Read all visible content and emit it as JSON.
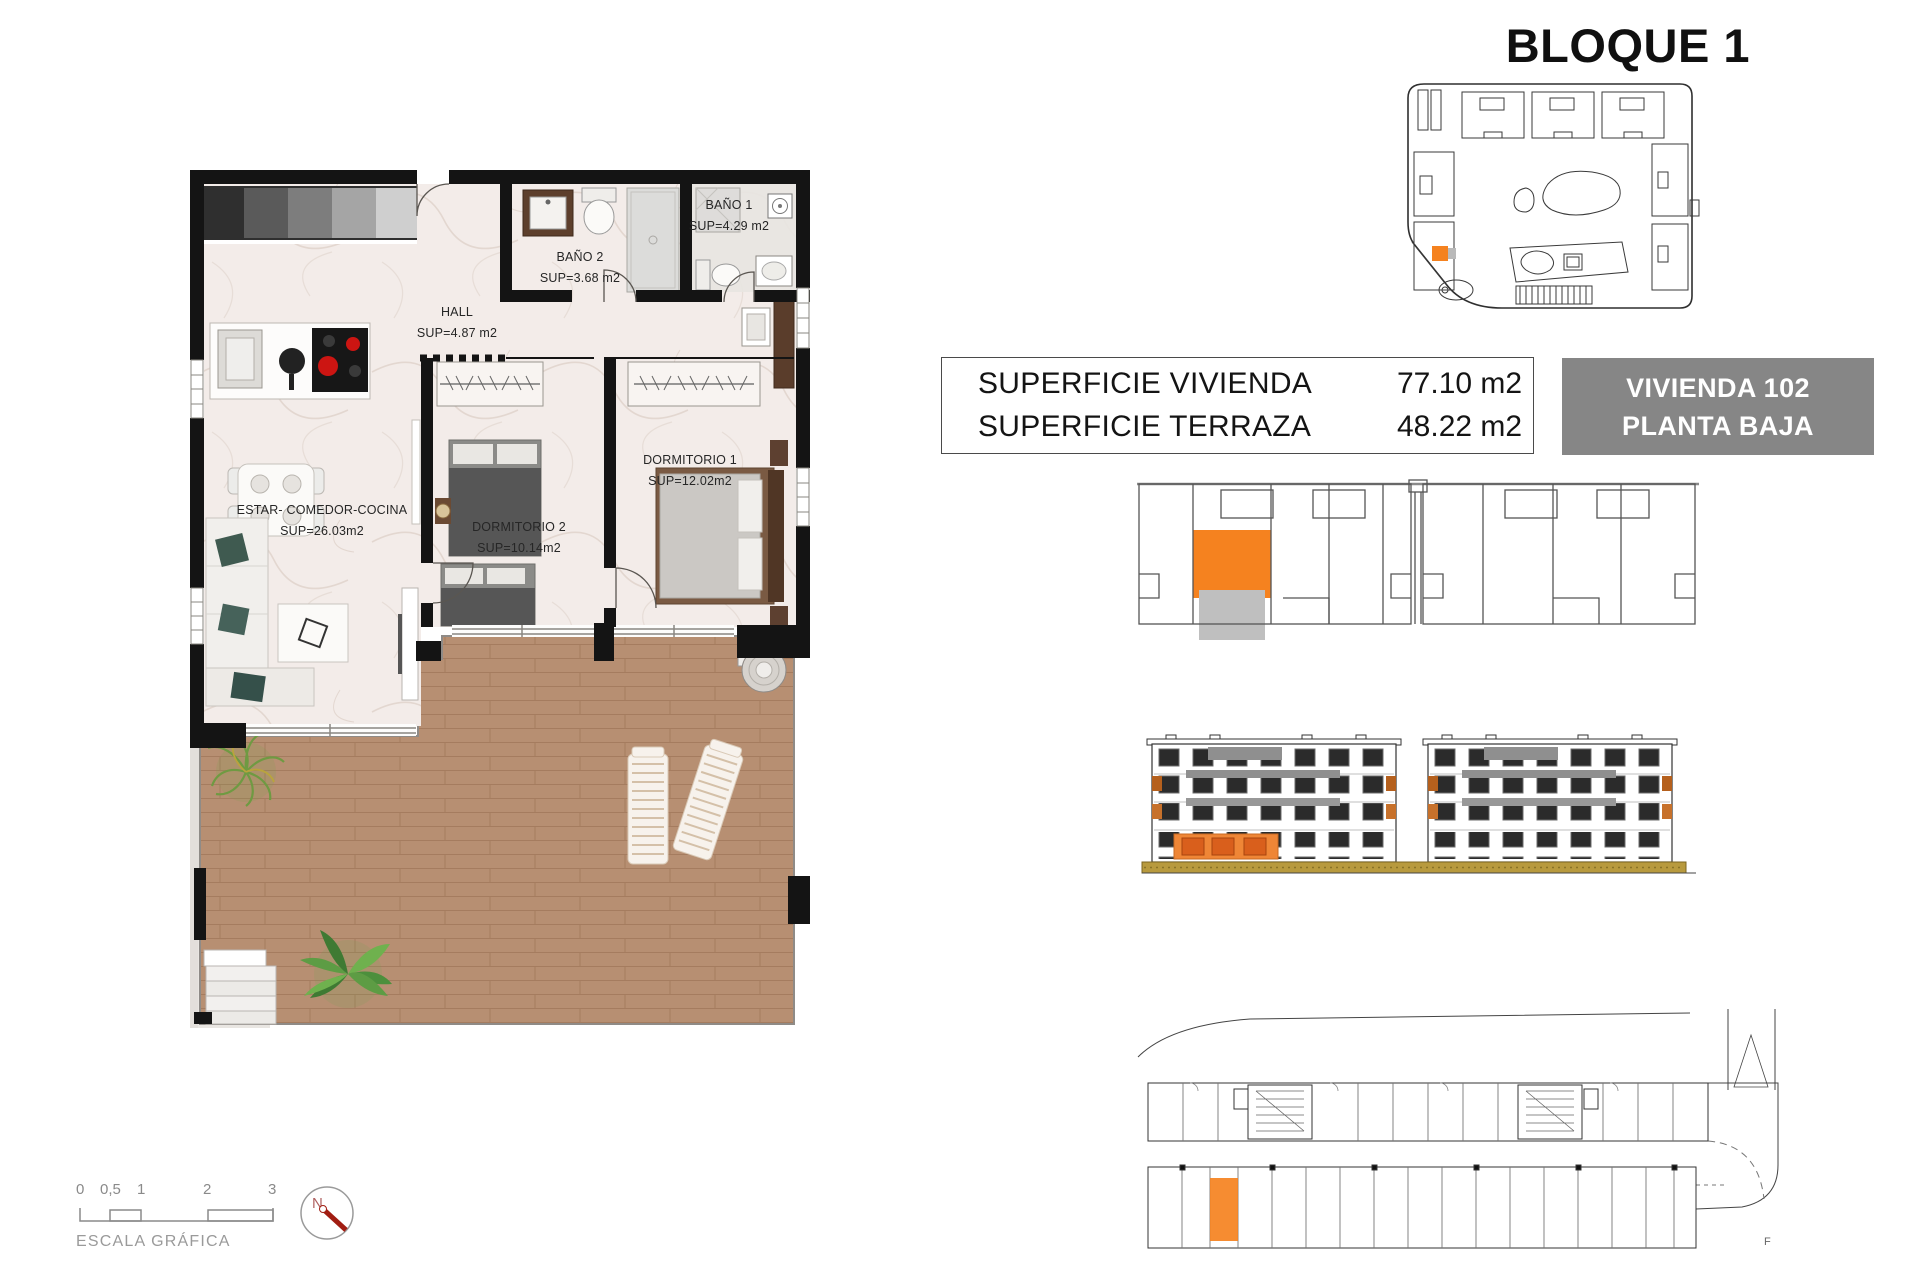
{
  "title": "BLOQUE 1",
  "summary_table": {
    "rows": [
      {
        "label": "SUPERFICIE VIVIENDA",
        "value": "77.10 m2"
      },
      {
        "label": "SUPERFICIE TERRAZA",
        "value": "48.22 m2"
      }
    ]
  },
  "unit_badge": {
    "line1": "VIVIENDA 102",
    "line2": "PLANTA BAJA"
  },
  "floor_plan": {
    "rooms": [
      {
        "name": "ESTAR- COMEDOR-COCINA",
        "area": "SUP=26.03m2"
      },
      {
        "name": "DORMITORIO 2",
        "area": "SUP=10.14m2"
      },
      {
        "name": "DORMITORIO 1",
        "area": "SUP=12.02m2"
      },
      {
        "name": "HALL",
        "area": "SUP=4.87 m2"
      },
      {
        "name": "BAÑO 2",
        "area": "SUP=3.68 m2"
      },
      {
        "name": "BAÑO 1",
        "area": "SUP=4.29 m2"
      }
    ]
  },
  "scale_bar": {
    "ticks": [
      "0",
      "0,5",
      "1",
      "2",
      "3"
    ],
    "caption": "ESCALA GRÁFICA"
  },
  "compass": {
    "label": "N"
  },
  "parking": {
    "ref_mark": "F"
  },
  "colors": {
    "highlight_orange": "#F5821F",
    "badge_gray": "#868686",
    "terrace_wood": "#B78F72",
    "elevation_ground": "#B89A3E"
  }
}
